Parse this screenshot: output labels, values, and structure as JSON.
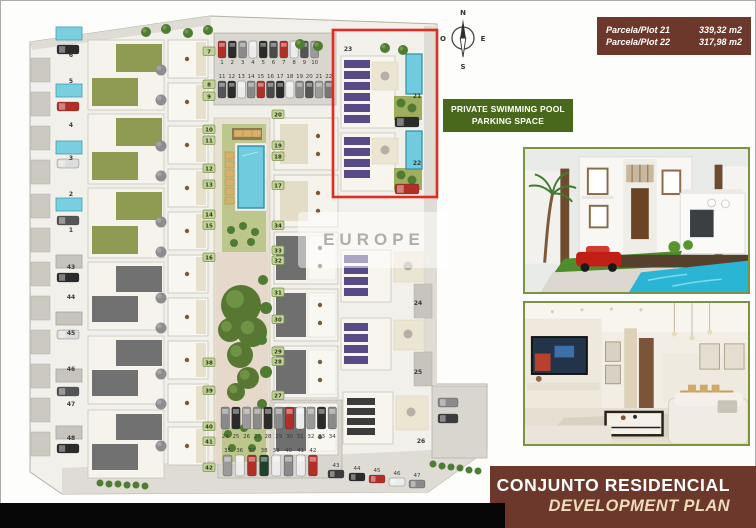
{
  "colors": {
    "maroon": "#6b382b",
    "green": "#4a681c",
    "cream": "#eedcba",
    "photo_frame": "#7c9440",
    "pool_blue": "#6fcbdd"
  },
  "legend": {
    "plots": [
      {
        "label": "Parcela/Plot 21",
        "value": "339,32 m2"
      },
      {
        "label": "Parcela/Plot 22",
        "value": "317,98 m2"
      }
    ],
    "features": {
      "line1": "PRIVATE SWIMMING POOL",
      "line2": "PARKING SPACE"
    }
  },
  "banner": {
    "title": "CONJUNTO RESIDENCIAL",
    "subtitle": "DEVELOPMENT PLAN"
  },
  "compass": {
    "north": "N",
    "east": "E",
    "south": "S",
    "west": "O"
  },
  "watermark": {
    "text": "EUROPE"
  },
  "site_plan": {
    "base": {
      "points": "30,42 210,16 437,24 437,200 432,204 432,384 487,384 487,450 428,492 62,494 30,472",
      "fill": "#f2f0ea",
      "stroke": "#b3b0a6"
    },
    "roads": [
      {
        "points": "30,42 210,16 211,25 32,50",
        "fill": "#dedcd5"
      },
      {
        "rect": [
          424,
          26,
          13,
          360
        ],
        "fill": "#dedcd5"
      },
      {
        "points": "62,468 432,450 487,450 428,492 62,494",
        "fill": "#dedcd5"
      }
    ],
    "lots": [
      [
        214,
        33,
        122,
        72
      ],
      [
        218,
        400,
        124,
        78
      ]
    ],
    "left_strip": {
      "x": 31,
      "w": 19,
      "h": 24,
      "ys": [
        58,
        92,
        126,
        160,
        194,
        228,
        262,
        296,
        330,
        364,
        398,
        432
      ]
    },
    "small_pools": {
      "w": 26,
      "h": 13,
      "cyan": [
        [
          56,
          27
        ],
        [
          56,
          84
        ],
        [
          56,
          141
        ],
        [
          56,
          198
        ]
      ],
      "gray": [
        [
          56,
          255
        ],
        [
          56,
          312
        ],
        [
          56,
          369
        ],
        [
          56,
          426
        ]
      ]
    },
    "left_cars": [
      [
        57,
        45,
        "#2b2b2b"
      ],
      [
        57,
        102,
        "#b03028"
      ],
      [
        57,
        159,
        "#dcdcdc"
      ],
      [
        57,
        216,
        "#555555"
      ],
      [
        57,
        273,
        "#2b2b2b"
      ],
      [
        57,
        330,
        "#dcdcdc"
      ],
      [
        57,
        387,
        "#555555"
      ],
      [
        57,
        444,
        "#2b2b2b"
      ]
    ],
    "green_houses": {
      "x": 88,
      "w": 76,
      "h": 70,
      "ys": [
        40,
        114,
        188
      ]
    },
    "dark_houses": {
      "x": 88,
      "w": 76,
      "h": 68,
      "ys": [
        262,
        336,
        410
      ]
    },
    "tree_column": [
      [
        161,
        70
      ],
      [
        161,
        100
      ],
      [
        161,
        146
      ],
      [
        161,
        176
      ],
      [
        161,
        222
      ],
      [
        161,
        252
      ],
      [
        161,
        298
      ],
      [
        161,
        328
      ],
      [
        161,
        374
      ],
      [
        161,
        404
      ],
      [
        161,
        446
      ]
    ],
    "mid_houses": {
      "x": 168,
      "w": 40,
      "h": 38,
      "ys": [
        40,
        83,
        126,
        169,
        212,
        255,
        298,
        341,
        384,
        427
      ]
    },
    "amenity": {
      "deck": [
        214,
        118,
        56,
        346
      ],
      "lawn_top": [
        222,
        124,
        44,
        128
      ],
      "path": [
        216,
        252,
        52,
        212
      ],
      "lawn_bottom": [
        222,
        428,
        44,
        34
      ],
      "pergola": [
        232,
        128,
        30,
        12
      ],
      "loungers": [
        [
          234,
          130
        ],
        [
          243,
          130
        ],
        [
          252,
          130
        ],
        [
          225,
          152
        ],
        [
          225,
          161
        ],
        [
          225,
          170
        ],
        [
          225,
          179
        ],
        [
          225,
          188
        ],
        [
          225,
          197
        ]
      ],
      "pool_surround": [
        235,
        143,
        32,
        68
      ],
      "pool": [
        238,
        146,
        26,
        62
      ],
      "trees": [
        [
          231,
          230
        ],
        [
          243,
          226
        ],
        [
          255,
          232
        ],
        [
          234,
          243
        ],
        [
          251,
          242
        ],
        [
          228,
          434
        ],
        [
          244,
          428
        ],
        [
          258,
          438
        ],
        [
          232,
          448
        ],
        [
          252,
          448
        ]
      ],
      "blob": [
        [
          241,
          305,
          20
        ],
        [
          230,
          330,
          12
        ],
        [
          252,
          332,
          15
        ],
        [
          240,
          355,
          13
        ],
        [
          248,
          378,
          11
        ],
        [
          236,
          392,
          9
        ]
      ],
      "bushes": [
        [
          263,
          280,
          5
        ],
        [
          266,
          308,
          6
        ],
        [
          262,
          340,
          5
        ],
        [
          266,
          372,
          6
        ],
        [
          262,
          404,
          5
        ]
      ]
    },
    "midright_houses": {
      "x": 274,
      "w": 64,
      "h": 52,
      "light_ys": [
        118,
        175
      ],
      "dark_ys": [
        232,
        289,
        346,
        403
      ]
    },
    "right_block": [
      432,
      386,
      55,
      72
    ],
    "right_cars": [
      [
        438,
        398,
        "#8a8a8a"
      ],
      [
        438,
        414,
        "#3c3c3c"
      ]
    ],
    "red_box": {
      "rect": [
        333,
        30,
        104,
        167
      ],
      "color": "#e02b20"
    },
    "villas": [
      {
        "b": [
          341,
          56,
          54,
          72
        ],
        "sx": 344,
        "sw": 26,
        "sh": 8,
        "sc": "#584a86",
        "sys": [
          60,
          71,
          82,
          93,
          104,
          115
        ],
        "patio": [
          372,
          62,
          26,
          28
        ],
        "table": [
          385,
          76
        ],
        "lawn": [
          394,
          96,
          28,
          24
        ],
        "trees": [
          [
            401,
            103
          ],
          [
            412,
            108
          ]
        ],
        "car": [
          395,
          117,
          24,
          10,
          "#2b2b2b"
        ],
        "pool": [
          406,
          54,
          16,
          40
        ]
      },
      {
        "b": [
          341,
          133,
          54,
          58
        ],
        "sx": 344,
        "sw": 26,
        "sh": 8,
        "sc": "#584a86",
        "sys": [
          137,
          148,
          159,
          170
        ],
        "patio": [
          372,
          138,
          26,
          26
        ],
        "table": [
          385,
          150
        ],
        "lawn": [
          394,
          168,
          28,
          22
        ],
        "trees": [
          [
            401,
            175
          ],
          [
            412,
            180
          ]
        ],
        "car": [
          395,
          184,
          24,
          10,
          "#b03028"
        ],
        "pool": [
          406,
          131,
          16,
          38
        ]
      },
      {
        "b": [
          341,
          250,
          50,
          52
        ],
        "sx": 344,
        "sw": 24,
        "sh": 8,
        "sc": "#584a86",
        "sys": [
          255,
          266,
          277,
          288
        ],
        "patio": [
          394,
          252,
          30,
          30
        ],
        "table": [
          408,
          266
        ],
        "drive": [
          414,
          284,
          18,
          34
        ]
      },
      {
        "b": [
          341,
          318,
          50,
          52
        ],
        "sx": 344,
        "sw": 24,
        "sh": 8,
        "sc": "#584a86",
        "sys": [
          323,
          334,
          345,
          356
        ],
        "patio": [
          394,
          320,
          30,
          30
        ],
        "table": [
          408,
          334
        ],
        "drive": [
          414,
          352,
          18,
          34
        ]
      },
      {
        "b": [
          343,
          392,
          50,
          52
        ],
        "sx": 347,
        "sw": 28,
        "sh": 7,
        "sc": "#3c3c3c",
        "sys": [
          398,
          408,
          418,
          428
        ],
        "patio": [
          396,
          396,
          32,
          34
        ],
        "table": [
          411,
          412
        ]
      }
    ],
    "parking_top": {
      "row1": {
        "labels": [
          "1",
          "2",
          "3",
          "4",
          "5",
          "6",
          "7",
          "8",
          "9",
          "10"
        ],
        "x0": 218,
        "dx": 10.3,
        "car_y": 41,
        "car_w": 8,
        "car_h": 17,
        "num_y": 64,
        "colors": [
          "#b03028",
          "#2b2b2b",
          "#8a8a8a",
          "#ececec",
          "#2b2b2b",
          "#4a4a4a",
          "#b03028",
          "#ececec",
          "#555555",
          "#9a9a9a"
        ]
      },
      "row2": {
        "labels": [
          "11",
          "12",
          "13",
          "14",
          "15",
          "16",
          "17",
          "18",
          "19",
          "20",
          "21",
          "22"
        ],
        "x0": 218,
        "dx": 9.7,
        "car_y": 81,
        "car_w": 8,
        "car_h": 17,
        "num_y": 78,
        "colors": [
          "#555555",
          "#2b2b2b",
          "#ececec",
          "#8a8a8a",
          "#b03028",
          "#4a4a4a",
          "#2b2b2b",
          "#ececec",
          "#8a8a8a",
          "#555555",
          "#9a9a9a",
          "#777777"
        ]
      }
    },
    "parking_bottom": {
      "row1": {
        "labels": [
          "24",
          "25",
          "26",
          "27",
          "28",
          "29",
          "30",
          "31",
          "32",
          "33",
          "34"
        ],
        "x0": 221,
        "dx": 10.7,
        "car_y": 407,
        "car_w": 8.5,
        "car_h": 22,
        "num_y": 438,
        "colors": [
          "#8a8a8a",
          "#2b2b2b",
          "#9a9a9a",
          "#8a8a8a",
          "#2b2b2b",
          "#8a8a8a",
          "#b03028",
          "#ececec",
          "#9a9a9a",
          "#2b2b2b",
          "#8a8a8a"
        ]
      },
      "row2": {
        "labels": [
          "35",
          "36",
          "37",
          "38",
          "39",
          "40",
          "41",
          "42"
        ],
        "x0": 223,
        "dx": 12.2,
        "car_y": 455,
        "car_w": 9,
        "car_h": 21,
        "num_y": 452,
        "colors": [
          "#9a9a9a",
          "#ececec",
          "#b03028",
          "#22402e",
          "#ececec",
          "#8a8a8a",
          "#ececec",
          "#b03028"
        ]
      }
    },
    "diag_parking": {
      "labels": [
        "43",
        "44",
        "45",
        "46",
        "47"
      ],
      "nums": [
        [
          336,
          467
        ],
        [
          357,
          470
        ],
        [
          377,
          472
        ],
        [
          397,
          475
        ],
        [
          417,
          477
        ]
      ],
      "cars": [
        [
          328,
          470
        ],
        [
          349,
          473
        ],
        [
          369,
          475
        ],
        [
          389,
          478
        ],
        [
          409,
          480
        ]
      ],
      "car_w": 16,
      "car_h": 8,
      "colors": [
        "#3c3c3c",
        "#2b2b2b",
        "#b03028",
        "#ececec",
        "#8a8a8a"
      ]
    },
    "plot_labels": [
      [
        71,
        57,
        "6"
      ],
      [
        71,
        83,
        "5"
      ],
      [
        71,
        127,
        "4"
      ],
      [
        71,
        160,
        "3"
      ],
      [
        71,
        196,
        "2"
      ],
      [
        71,
        232,
        "1"
      ],
      [
        71,
        269,
        "43"
      ],
      [
        71,
        299,
        "44"
      ],
      [
        71,
        335,
        "45"
      ],
      [
        71,
        371,
        "46"
      ],
      [
        71,
        406,
        "47"
      ],
      [
        71,
        440,
        "48"
      ],
      [
        348,
        51,
        "23"
      ],
      [
        417,
        98,
        "21"
      ],
      [
        417,
        165,
        "22"
      ],
      [
        418,
        305,
        "24"
      ],
      [
        418,
        374,
        "25"
      ],
      [
        421,
        443,
        "26"
      ]
    ],
    "tags": [
      [
        203,
        47,
        "7"
      ],
      [
        203,
        80,
        "8"
      ],
      [
        203,
        92,
        "9"
      ],
      [
        203,
        125,
        "10"
      ],
      [
        203,
        136,
        "11"
      ],
      [
        203,
        164,
        "12"
      ],
      [
        203,
        180,
        "13"
      ],
      [
        203,
        210,
        "14"
      ],
      [
        203,
        221,
        "15"
      ],
      [
        203,
        253,
        "16"
      ],
      [
        203,
        358,
        "38"
      ],
      [
        203,
        386,
        "39"
      ],
      [
        203,
        422,
        "40"
      ],
      [
        203,
        437,
        "41"
      ],
      [
        203,
        463,
        "42"
      ],
      [
        272,
        110,
        "20"
      ],
      [
        272,
        141,
        "19"
      ],
      [
        272,
        152,
        "18"
      ],
      [
        272,
        181,
        "17"
      ],
      [
        272,
        221,
        "34"
      ],
      [
        272,
        246,
        "33"
      ],
      [
        272,
        256,
        "32"
      ],
      [
        272,
        288,
        "31"
      ],
      [
        272,
        315,
        "30"
      ],
      [
        272,
        347,
        "29"
      ],
      [
        272,
        357,
        "28"
      ],
      [
        272,
        391,
        "27"
      ]
    ],
    "top_trees": [
      [
        146,
        32
      ],
      [
        166,
        29
      ],
      [
        188,
        33
      ],
      [
        208,
        30
      ],
      [
        300,
        44
      ],
      [
        318,
        46
      ],
      [
        385,
        48
      ],
      [
        403,
        50
      ]
    ],
    "bushes_bottom": [
      [
        100,
        483
      ],
      [
        109,
        484
      ],
      [
        118,
        484
      ],
      [
        127,
        485
      ],
      [
        136,
        485
      ],
      [
        145,
        486
      ],
      [
        433,
        464
      ],
      [
        442,
        466
      ],
      [
        451,
        467
      ],
      [
        460,
        468
      ],
      [
        469,
        470
      ],
      [
        478,
        471
      ]
    ]
  }
}
